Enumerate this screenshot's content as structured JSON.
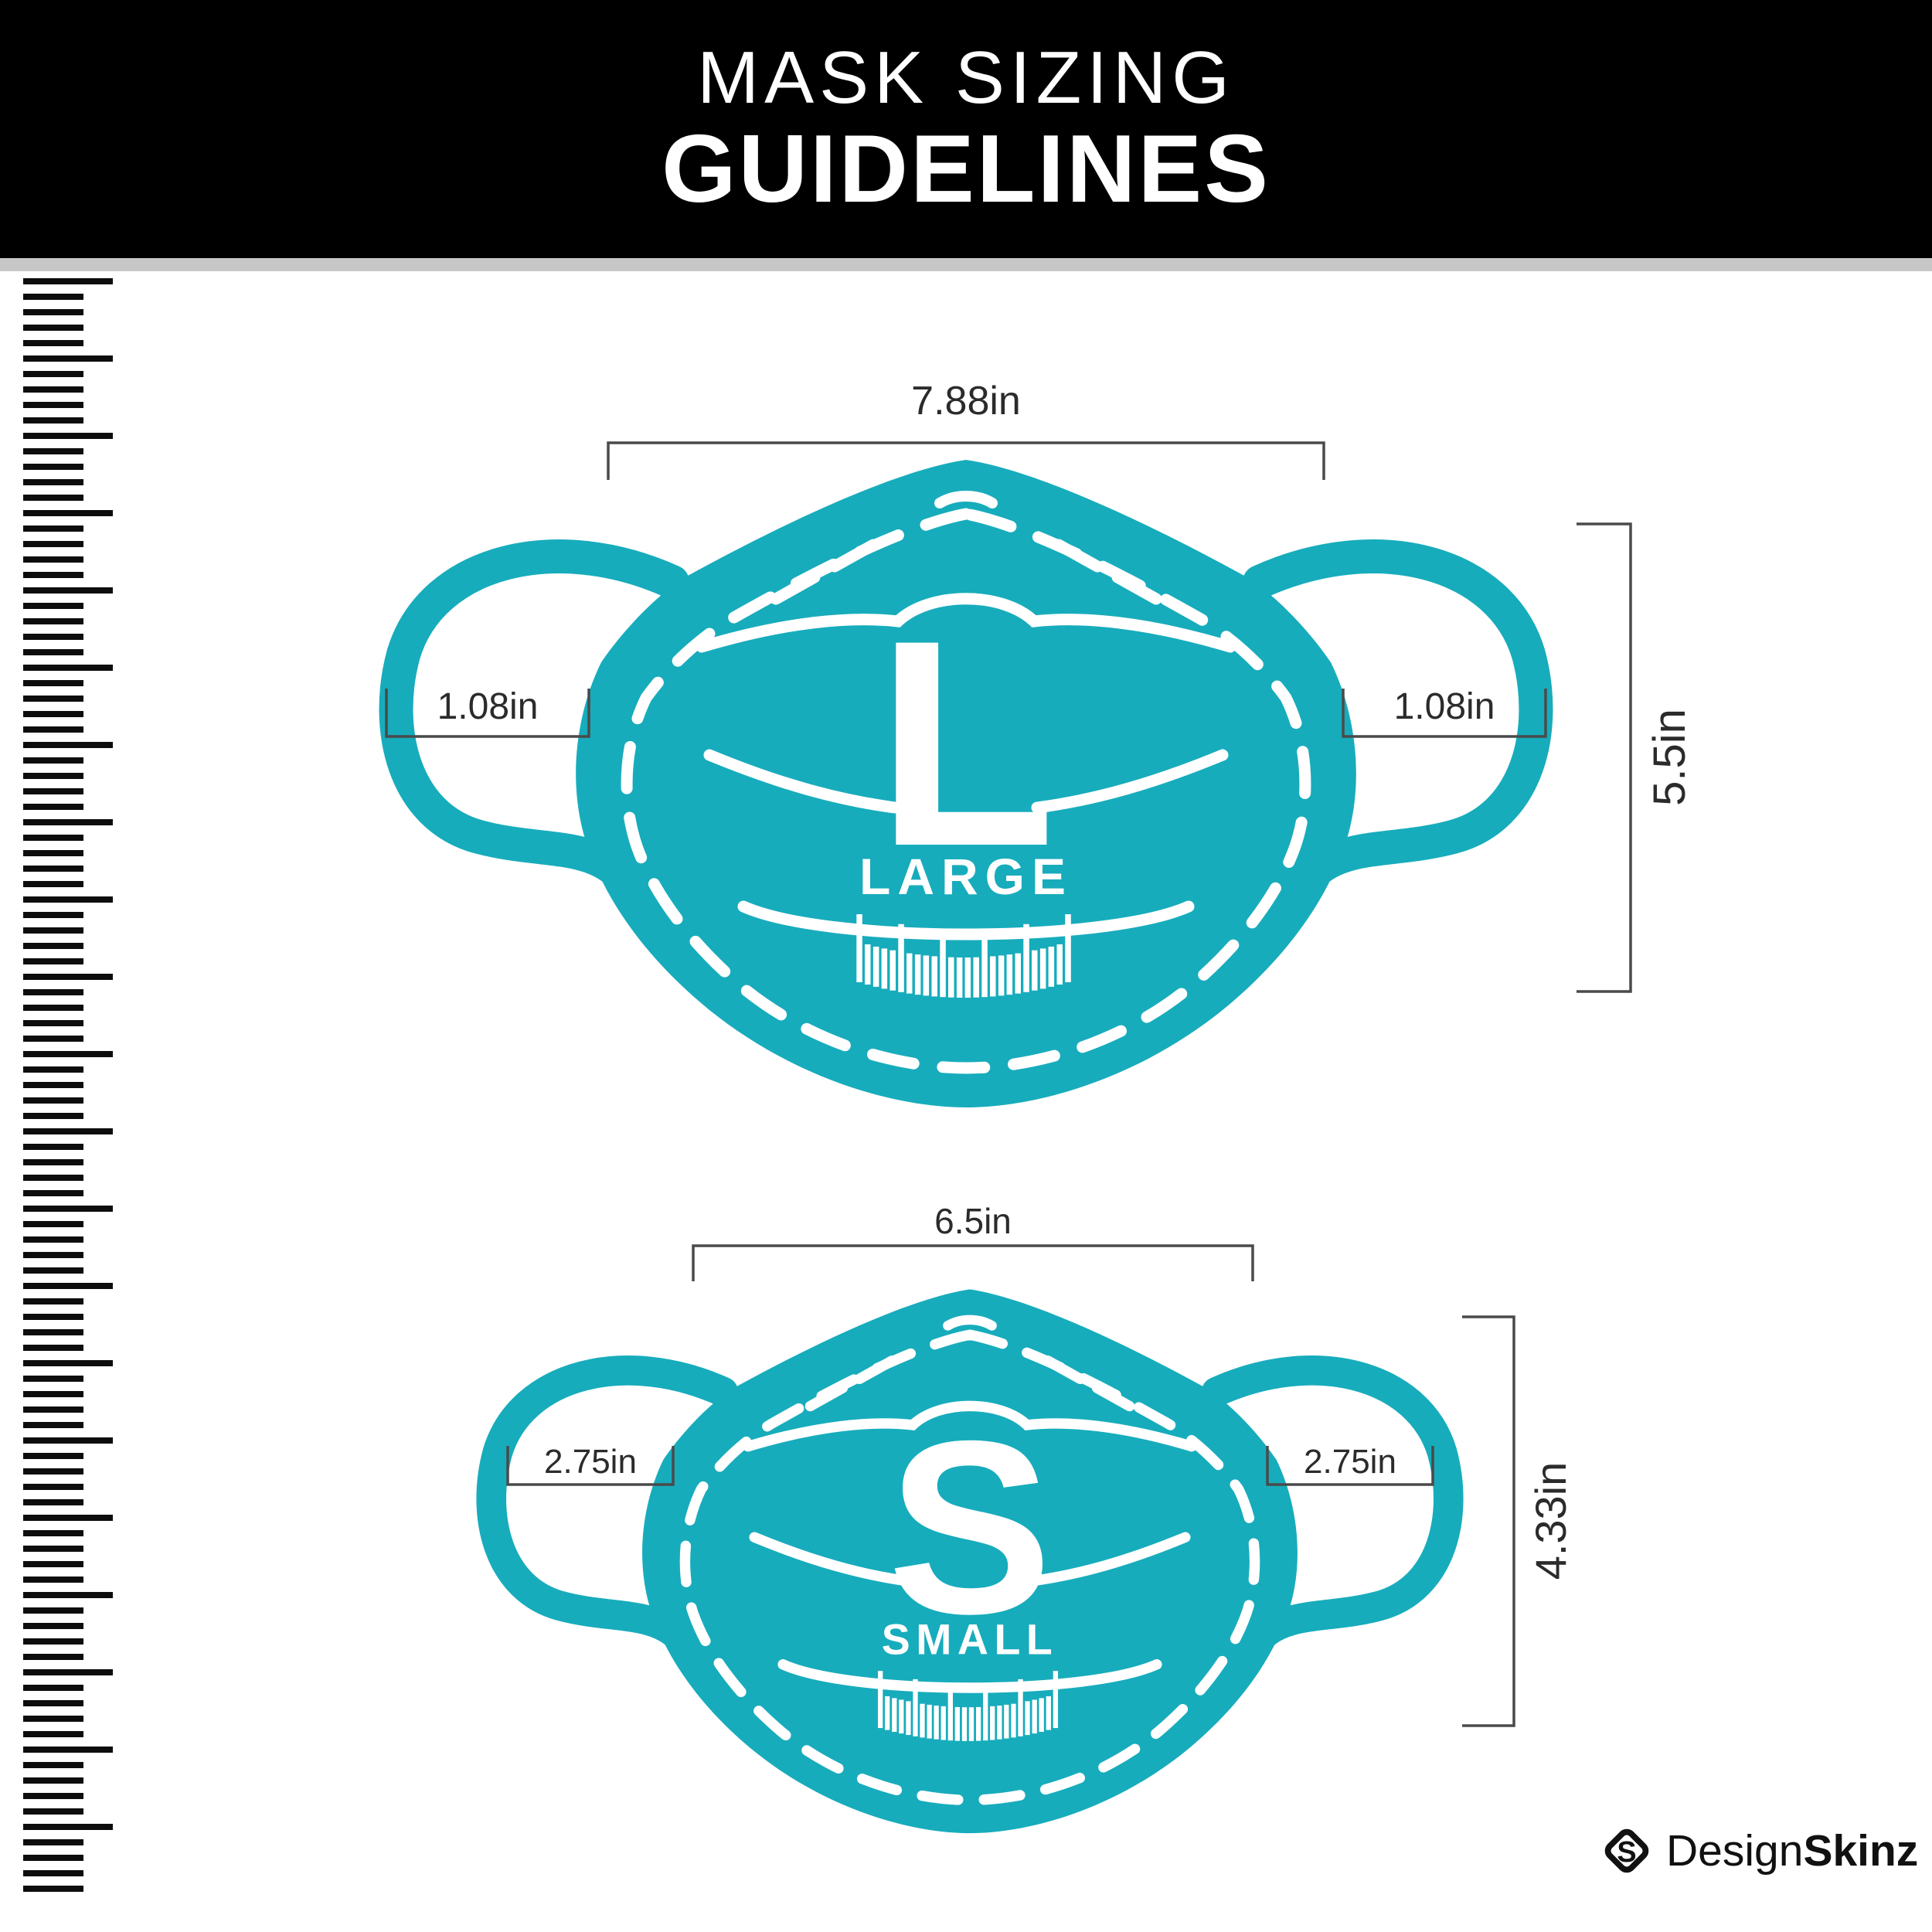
{
  "header": {
    "title_line1": "MASK SIZING",
    "title_line2": "GUIDELINES"
  },
  "masks": [
    {
      "id": "large",
      "letter": "L",
      "size_label": "LARGE",
      "width_label": "7.88in",
      "height_label": "5.5in",
      "ear_left_label": "1.08in",
      "ear_right_label": "1.08in"
    },
    {
      "id": "small",
      "letter": "S",
      "size_label": "SMALL",
      "width_label": "6.5in",
      "height_label": "4.33in",
      "ear_left_label": "2.75in",
      "ear_right_label": "2.75in"
    }
  ],
  "footer": {
    "brand_regular": "Design",
    "brand_bold": "Skinz",
    "brand_icon": "designskinz-diamond-s-icon"
  },
  "colors": {
    "mask_teal": "#17acbc",
    "header_bg": "#000000",
    "divider_gray": "#c7c7c7",
    "dimension_line": "#4a4a4a",
    "label_text": "#2b2b2b",
    "ruler_black": "#0d0d0d",
    "title_text": "#ffffff"
  }
}
